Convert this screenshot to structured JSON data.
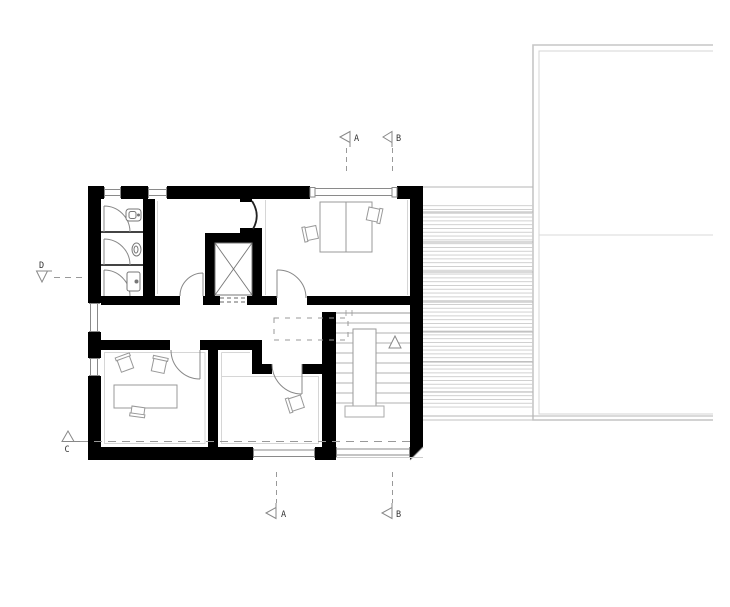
{
  "drawing": {
    "kind": "architectural-floor-plan",
    "markers": {
      "top": [
        {
          "label": "A"
        },
        {
          "label": "B"
        }
      ],
      "bottom": [
        {
          "label": "A"
        },
        {
          "label": "B"
        }
      ],
      "left": [
        {
          "label": "D"
        },
        {
          "label": "C"
        }
      ]
    },
    "colors": {
      "wall": "#000000",
      "thin_line": "#888888",
      "hatch_line": "#c9c9c9",
      "dash_line": "#999999",
      "neighbor_outline": "#c6c6c6"
    }
  }
}
